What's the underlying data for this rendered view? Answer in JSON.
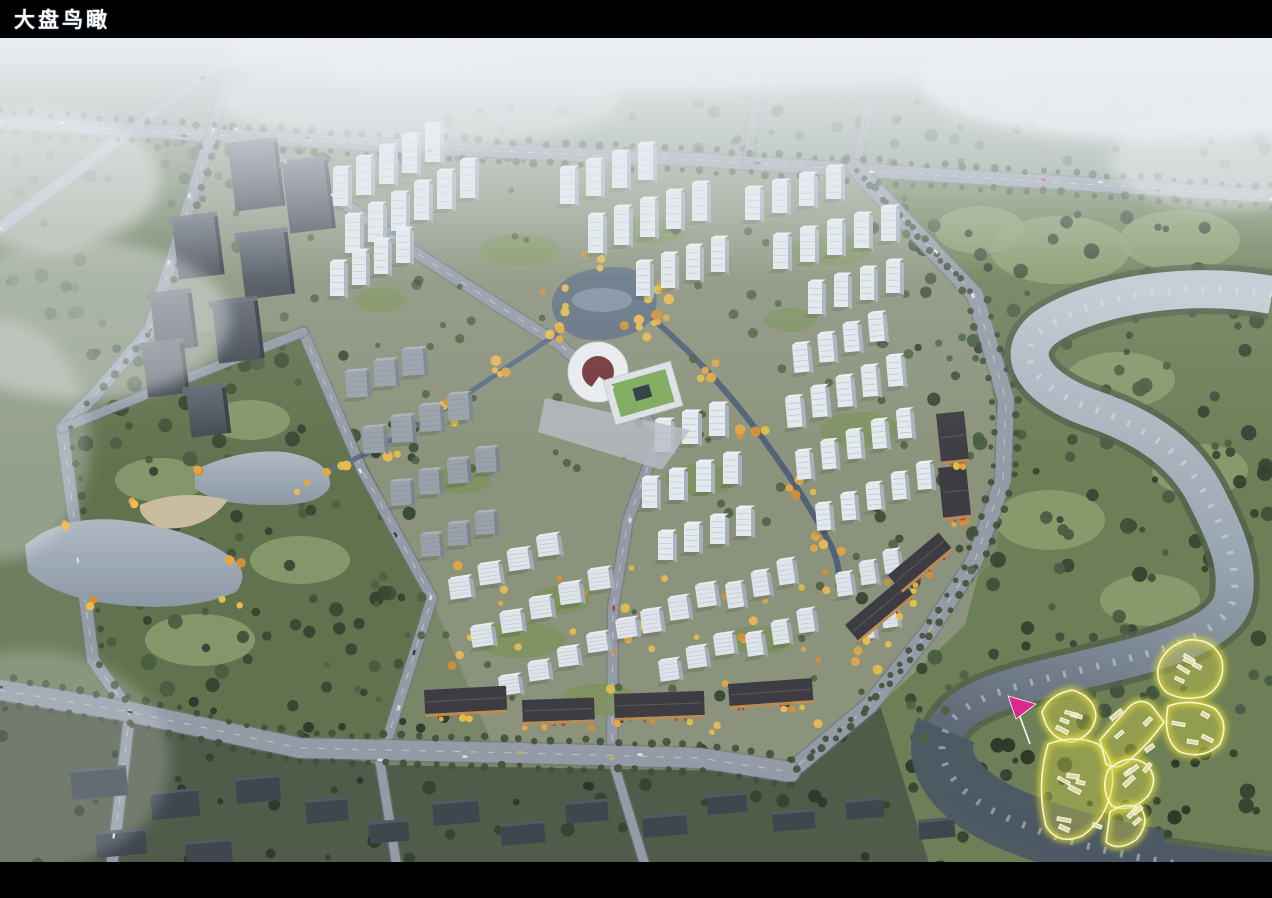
{
  "slide": {
    "title": "大盘鸟瞰"
  },
  "colors": {
    "title_bar_bg": "#000000",
    "title_text": "#ffffff",
    "highlight_fill": "#d8d23f",
    "highlight_outline": "#fbf9d8",
    "highlight_glow": "#e8e227",
    "marker_arrow": "#e01f8d",
    "water_silver": "#c6cdd4",
    "water_dark": "#49545e",
    "autumn_tree": "#e8a83c",
    "fog": "#f2f4f6"
  }
}
